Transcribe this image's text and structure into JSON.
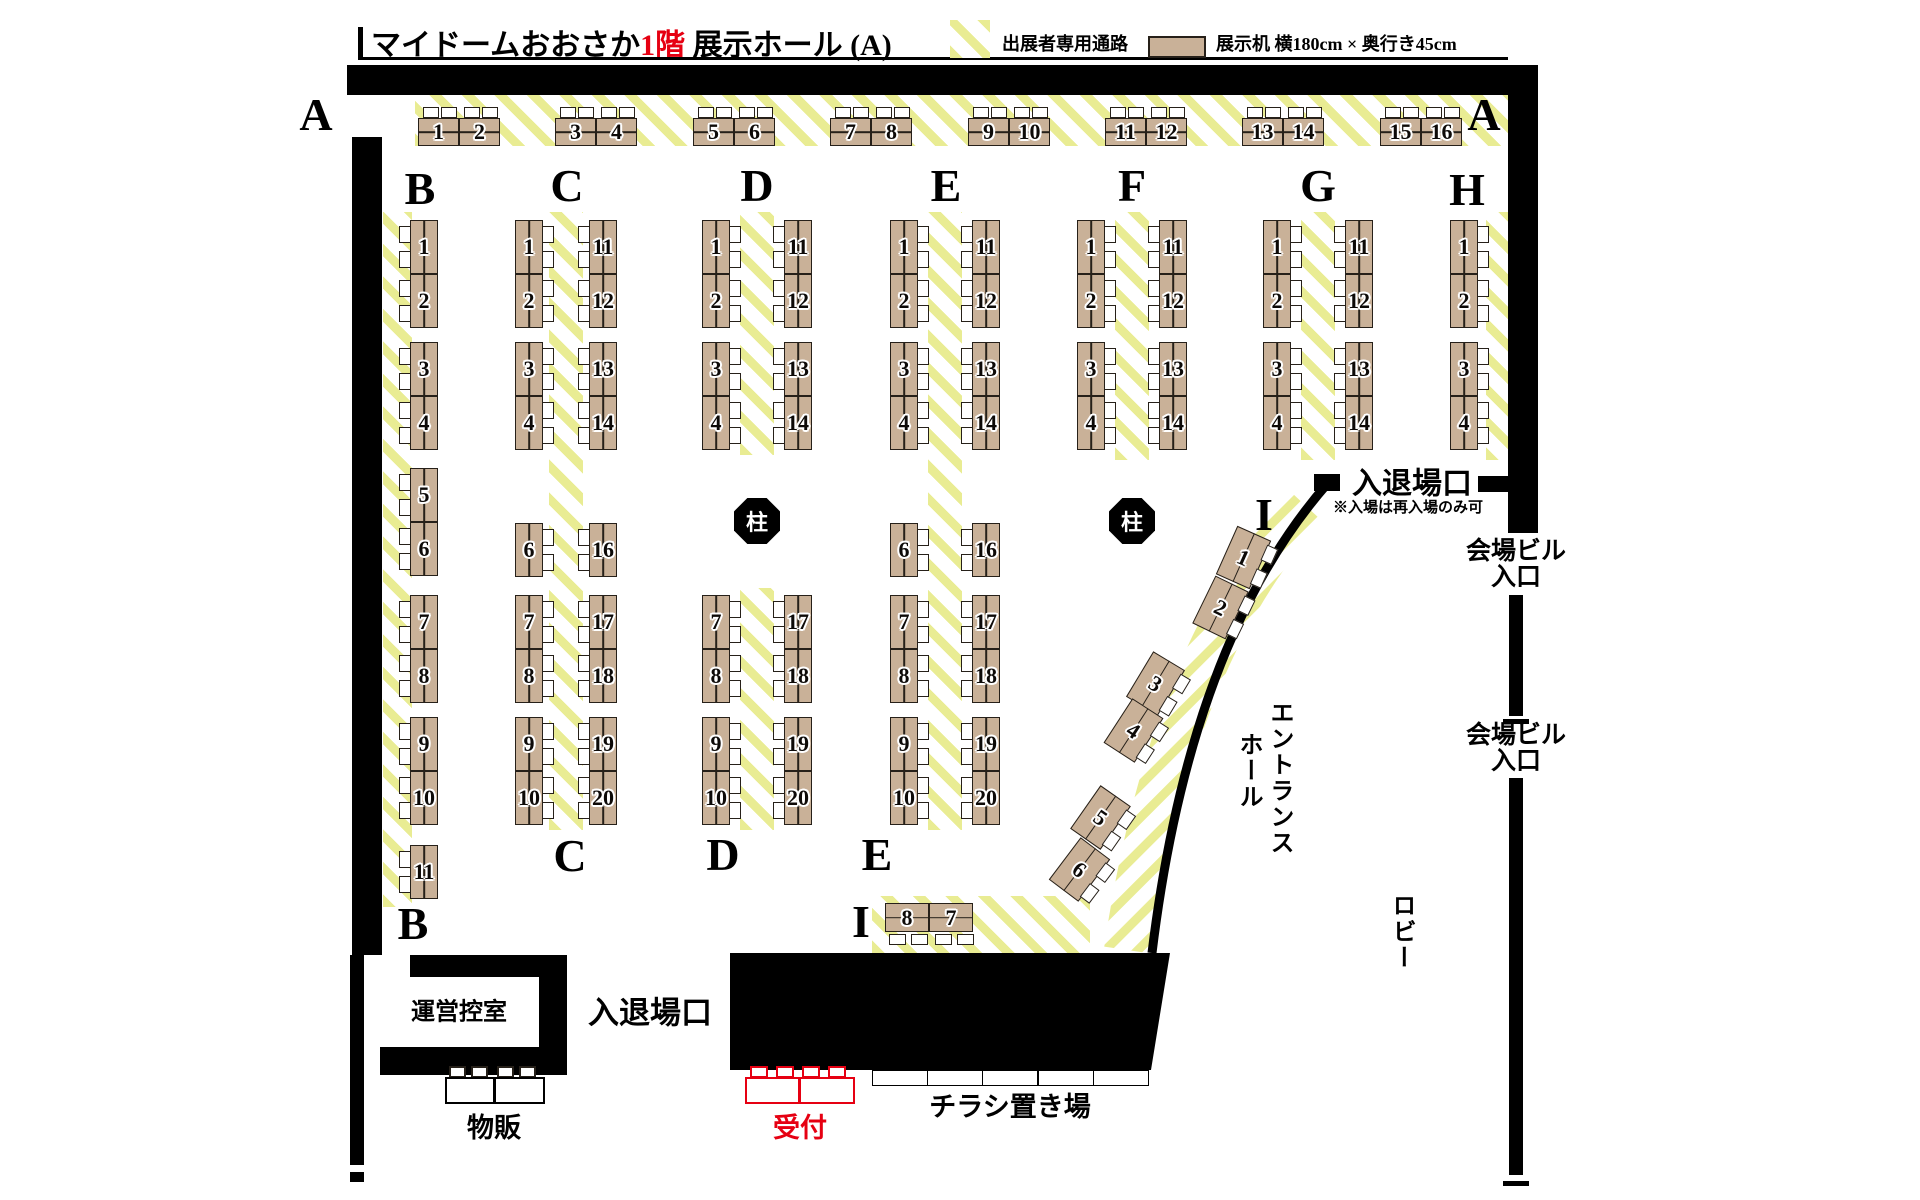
{
  "title": {
    "bar": "|",
    "venue": "マイドームおおさか",
    "floor": "1階",
    "hall": " 展示ホール (A)"
  },
  "legend": {
    "aisle": "出展者専用通路",
    "desk": "展示机 横180cm × 奥行き45cm"
  },
  "labels": {
    "pillar": "柱",
    "entrance_top": "入退場口",
    "entrance_top_note": "※入場は再入場のみ可",
    "entrance_bottom": "入退場口",
    "building_entrance": [
      "会場ビル",
      "入口"
    ],
    "entrance_hall": [
      "エントランス",
      "ホール"
    ],
    "lobby": "ロビー",
    "staff_room": "運営控室",
    "merch": "物販",
    "reception": "受付",
    "flyers": "チラシ置き場"
  },
  "sections": [
    "A",
    "B",
    "C",
    "D",
    "E",
    "F",
    "G",
    "H",
    "I"
  ],
  "columns": {
    "A": [
      1,
      2,
      3,
      4,
      5,
      6,
      7,
      8,
      9,
      10,
      11,
      12,
      13,
      14,
      15,
      16
    ],
    "B": [
      1,
      2,
      3,
      4,
      5,
      6,
      7,
      8,
      9,
      10,
      11
    ],
    "C_left": [
      1,
      2,
      3,
      4,
      6,
      7,
      8,
      9,
      10
    ],
    "C_right": [
      11,
      12,
      13,
      14,
      16,
      17,
      18,
      19,
      20
    ],
    "D_left": [
      1,
      2,
      3,
      4,
      7,
      8,
      9,
      10
    ],
    "D_right": [
      11,
      12,
      13,
      14,
      17,
      18,
      19,
      20
    ],
    "E_left": [
      1,
      2,
      3,
      4,
      6,
      7,
      8,
      9,
      10
    ],
    "E_right": [
      11,
      12,
      13,
      14,
      16,
      17,
      18,
      19,
      20
    ],
    "F_left": [
      1,
      2,
      3,
      4
    ],
    "F_right": [
      11,
      12,
      13,
      14
    ],
    "G_left": [
      1,
      2,
      3,
      4
    ],
    "G_right": [
      11,
      12,
      13,
      14
    ],
    "H": [
      1,
      2,
      3,
      4
    ],
    "I_curve": [
      1,
      2,
      3,
      4,
      5,
      6
    ],
    "I_bottom": [
      8,
      7
    ]
  },
  "colors": {
    "desk_fill": "#c9b198",
    "stripe_yellow": "#e9ec93",
    "accent_red": "#e60012",
    "wall_black": "#000000"
  }
}
